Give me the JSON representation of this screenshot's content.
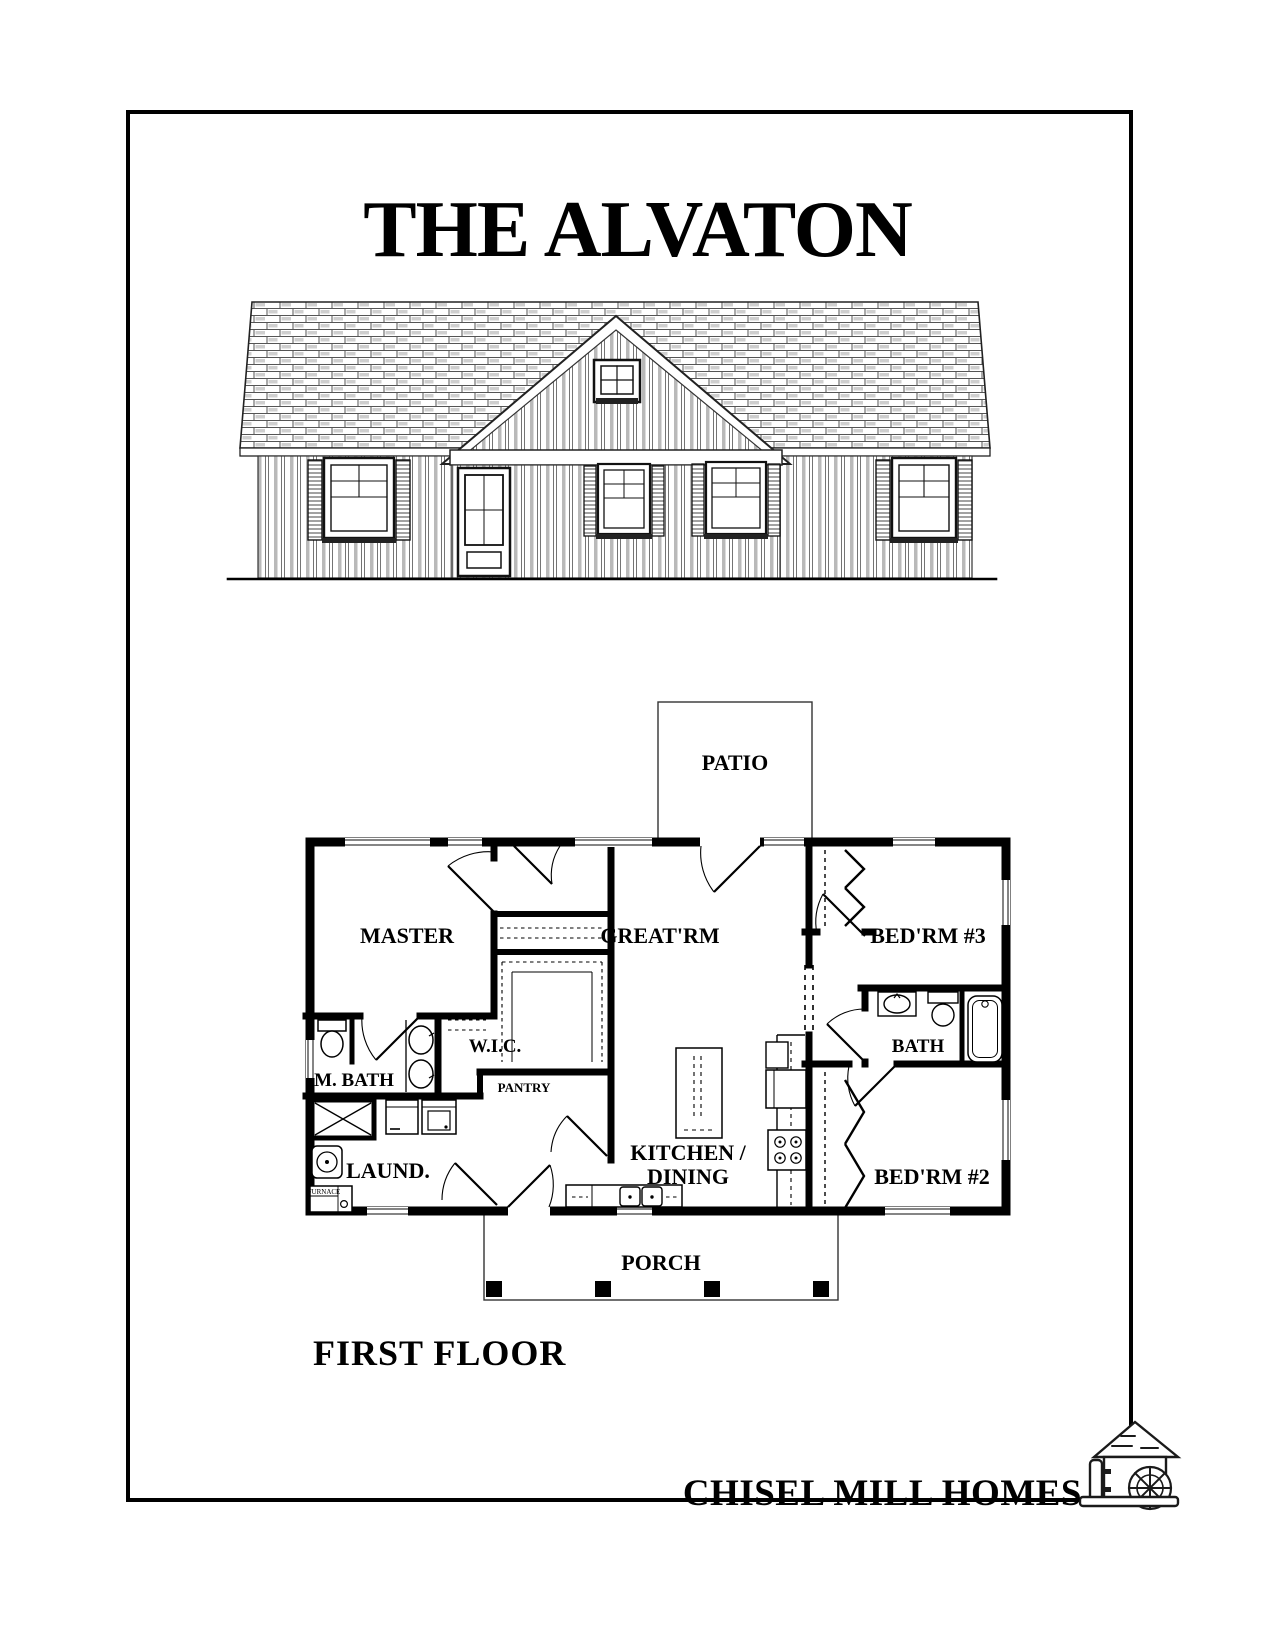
{
  "document": {
    "title": "THE ALVATON",
    "floor_label": "FIRST FLOOR",
    "brand": "CHISEL MILL HOMES"
  },
  "floor_plan": {
    "rooms": {
      "patio": "PATIO",
      "master": "MASTER",
      "great_room": "GREAT'RM",
      "bedroom3": "BED'RM #3",
      "wic": "W.I.C.",
      "master_bath": "M. BATH",
      "pantry": "PANTRY",
      "bath": "BATH",
      "laundry": "LAUND.",
      "kitchen_line1": "KITCHEN /",
      "kitchen_line2": "DINING",
      "bedroom2": "BED'RM #2",
      "porch": "PORCH"
    },
    "equipment": {
      "furnace": "FURNACE"
    }
  },
  "colors": {
    "ink": "#000000",
    "window_gray": "#858585",
    "line_gray": "#3a3a3a",
    "paper": "#ffffff"
  }
}
